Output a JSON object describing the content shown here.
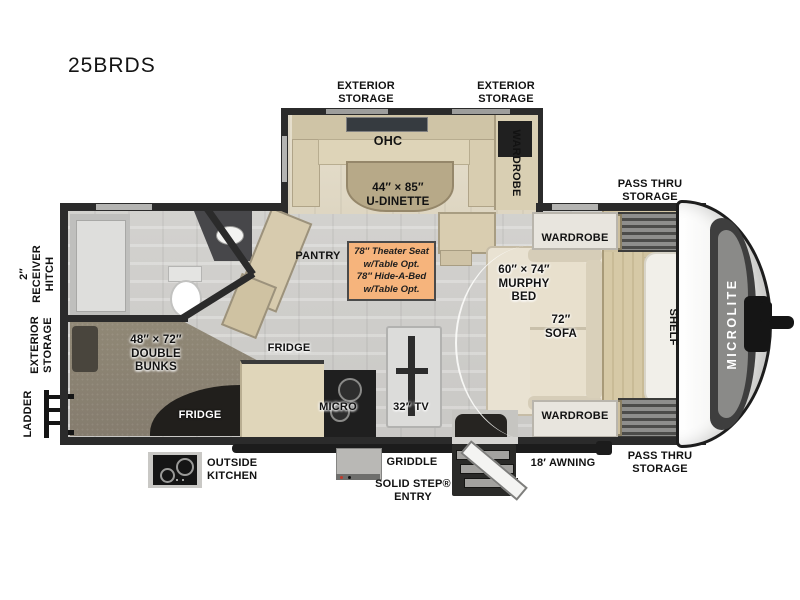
{
  "title": "25BRDS",
  "labels": {
    "ext_storage_left": "EXTERIOR\nSTORAGE",
    "ext_storage_right": "EXTERIOR\nSTORAGE",
    "pass_thru_top": "PASS THRU\nSTORAGE",
    "pass_thru_bottom": "PASS THRU\nSTORAGE",
    "ohc": "OHC",
    "u_dinette": "44″ × 85″\nU-DINETTE",
    "wardrobe_slide": "WARDROBE",
    "wardrobe_top": "WARDROBE",
    "wardrobe_bottom": "WARDROBE",
    "murphy_bed": "60″ × 74″\nMURPHY\nBED",
    "sofa": "72″\nSOFA",
    "shelf": "SHELF",
    "brand": "MICROLITE",
    "pantry": "PANTRY",
    "fridge_main": "FRIDGE",
    "fridge_outside": "FRIDGE",
    "micro": "MICRO",
    "tv": "32″ TV",
    "double_bunks": "48″ × 72″\nDOUBLE\nBUNKS",
    "receiver_hitch": "2″\nRECEIVER\nHITCH",
    "ext_storage_side": "EXTERIOR\nSTORAGE",
    "ladder": "LADDER",
    "outside_kitchen": "OUTSIDE\nKITCHEN",
    "griddle": "GRIDDLE",
    "solid_step": "SOLID STEP®\nENTRY",
    "awning": "18′ AWNING"
  },
  "note": {
    "text": "78″ Theater Seat\nw/Table Opt.\n78″ Hide-A-Bed\nw/Table Opt."
  },
  "colors": {
    "wall": "#2b2b2b",
    "floor": "#d0cfcc",
    "carpet": "#8b8173",
    "furniture_wood": "#d8cdb0",
    "slideout_floor": "#e4dcc9",
    "sofa_cream": "#e6decb",
    "note_bg": "#f6b47c",
    "note_border": "#4a4a4a",
    "cap_decal": "#3e3e3e"
  }
}
